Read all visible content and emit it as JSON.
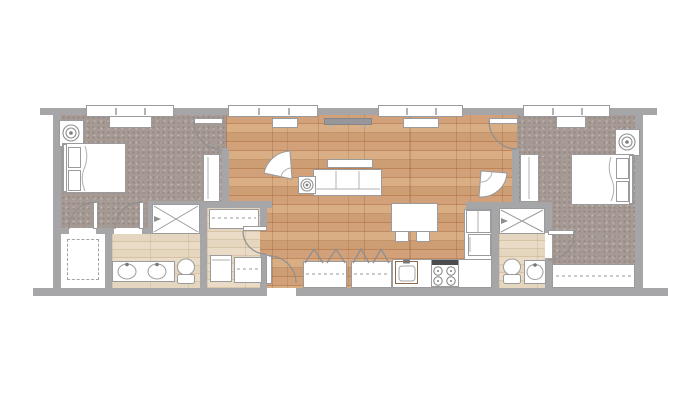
{
  "meta": {
    "description": "Top-down architectural floor plan of a two-bedroom, two-bath apartment with central open living, dining and kitchen area",
    "canvas_width": 700,
    "canvas_height": 400,
    "visible_text": []
  },
  "palette": {
    "background": "#ffffff",
    "wall": "#a6a6a8",
    "furniture_outline": "#9b9b9d",
    "carpet": "#a69a95",
    "hardwood": "#cb9a70",
    "light_wood": "#e0cfb6",
    "stove_panel": "#4c4c4e",
    "tv": "#97979b",
    "sink_counter_edge": "#8a6a4e"
  },
  "rooms": [
    {
      "name": "bedroom-1",
      "floor": "carpet",
      "furniture": [
        "bed",
        "nightstand-with-lamp",
        "dresser",
        "window-seat"
      ]
    },
    {
      "name": "walk-in-closet-1",
      "floor": "white",
      "furniture": [
        "shelving-dashed"
      ]
    },
    {
      "name": "bathroom-1",
      "floor": "light-wood",
      "fixtures": [
        "shower",
        "double-sink-vanity",
        "toilet"
      ]
    },
    {
      "name": "utility-hall",
      "floor": "light-wood",
      "fixtures": [
        "linen-shelf",
        "washer",
        "storage-shelf"
      ]
    },
    {
      "name": "living-dining-kitchen",
      "floor": "hardwood",
      "furniture": [
        "tv",
        "sofa",
        "console-table",
        "armchair",
        "armchair",
        "side-table-with-lamp",
        "dining-table",
        "dining-chair",
        "dining-chair"
      ]
    },
    {
      "name": "kitchen",
      "floor": "hardwood",
      "fixtures": [
        "refrigerator",
        "wall-appliance",
        "counter",
        "sink",
        "range"
      ]
    },
    {
      "name": "entry",
      "floor": "hardwood",
      "fixtures": [
        "entry-door"
      ]
    },
    {
      "name": "hall-closet-a",
      "fixtures": [
        "bifold-doors",
        "hanging-rod"
      ]
    },
    {
      "name": "hall-closet-b",
      "fixtures": [
        "bifold-doors",
        "hanging-rod"
      ]
    },
    {
      "name": "bathroom-2",
      "floor": "light-wood",
      "fixtures": [
        "shower",
        "toilet",
        "sink-vanity"
      ]
    },
    {
      "name": "bedroom-2",
      "floor": "carpet",
      "furniture": [
        "bed",
        "nightstand-with-lamp",
        "dresser",
        "window-seat",
        "wall-closet"
      ]
    }
  ],
  "openings": {
    "windows": 4,
    "hinged_doors": 7,
    "bifold_door_pairs": 2
  }
}
